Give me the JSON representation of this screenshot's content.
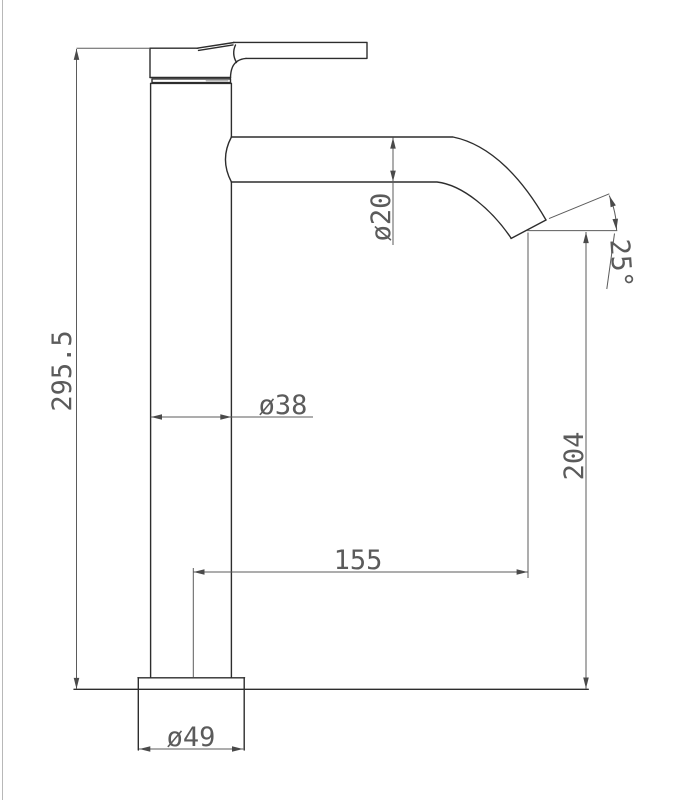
{
  "labels": {
    "overall_height": "295.5",
    "spout_outer_diameter": "ø20",
    "body_diameter": "ø38",
    "spout_reach": "155",
    "outlet_height": "204",
    "base_diameter": "ø49",
    "outlet_angle": "25°"
  },
  "colors": {
    "outline": "#2d2d2d",
    "dimension": "#5b5b5b",
    "text": "#5b5b5b",
    "frame": "#b8b8b8",
    "background": "#ffffff"
  }
}
